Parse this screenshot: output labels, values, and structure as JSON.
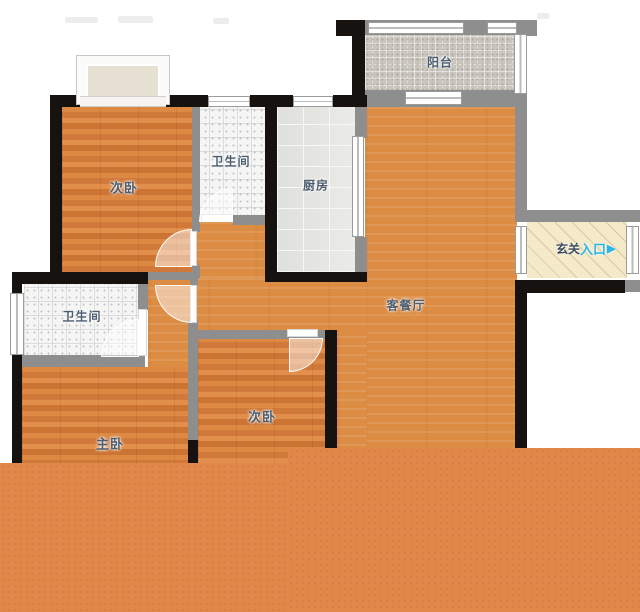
{
  "floorplan": {
    "title": "apartment-floor-plan",
    "rooms": {
      "bedroom_top": {
        "label": "次卧"
      },
      "bath_top": {
        "label": "卫生间"
      },
      "kitchen": {
        "label": "厨房"
      },
      "balcony": {
        "label": "阳台"
      },
      "living": {
        "label": "客餐厅"
      },
      "bath_left": {
        "label": "卫生间"
      },
      "master": {
        "label": "主卧"
      },
      "bedroom_bottom": {
        "label": "次卧"
      },
      "entry_hall": {
        "label": "玄关"
      },
      "entrance_marker": {
        "label": "入口",
        "arrow": "▶"
      }
    },
    "colors": {
      "bedroom_floor": "#d5803e",
      "living_floor": "#dd8c44",
      "bottom_band": "#e0874a",
      "wall_exterior": "#151210",
      "wall_interior": "#8e8e8e",
      "bath_tile": "#f5f5f3",
      "kitchen_tile": "#e9e9e6",
      "balcony_tile": "#c9c5bd",
      "entry_floor": "#f4e9c9",
      "room_label": "#4c5e70",
      "entry_label": "#3c4a5e",
      "entrance_label": "#2ab5e8"
    }
  }
}
